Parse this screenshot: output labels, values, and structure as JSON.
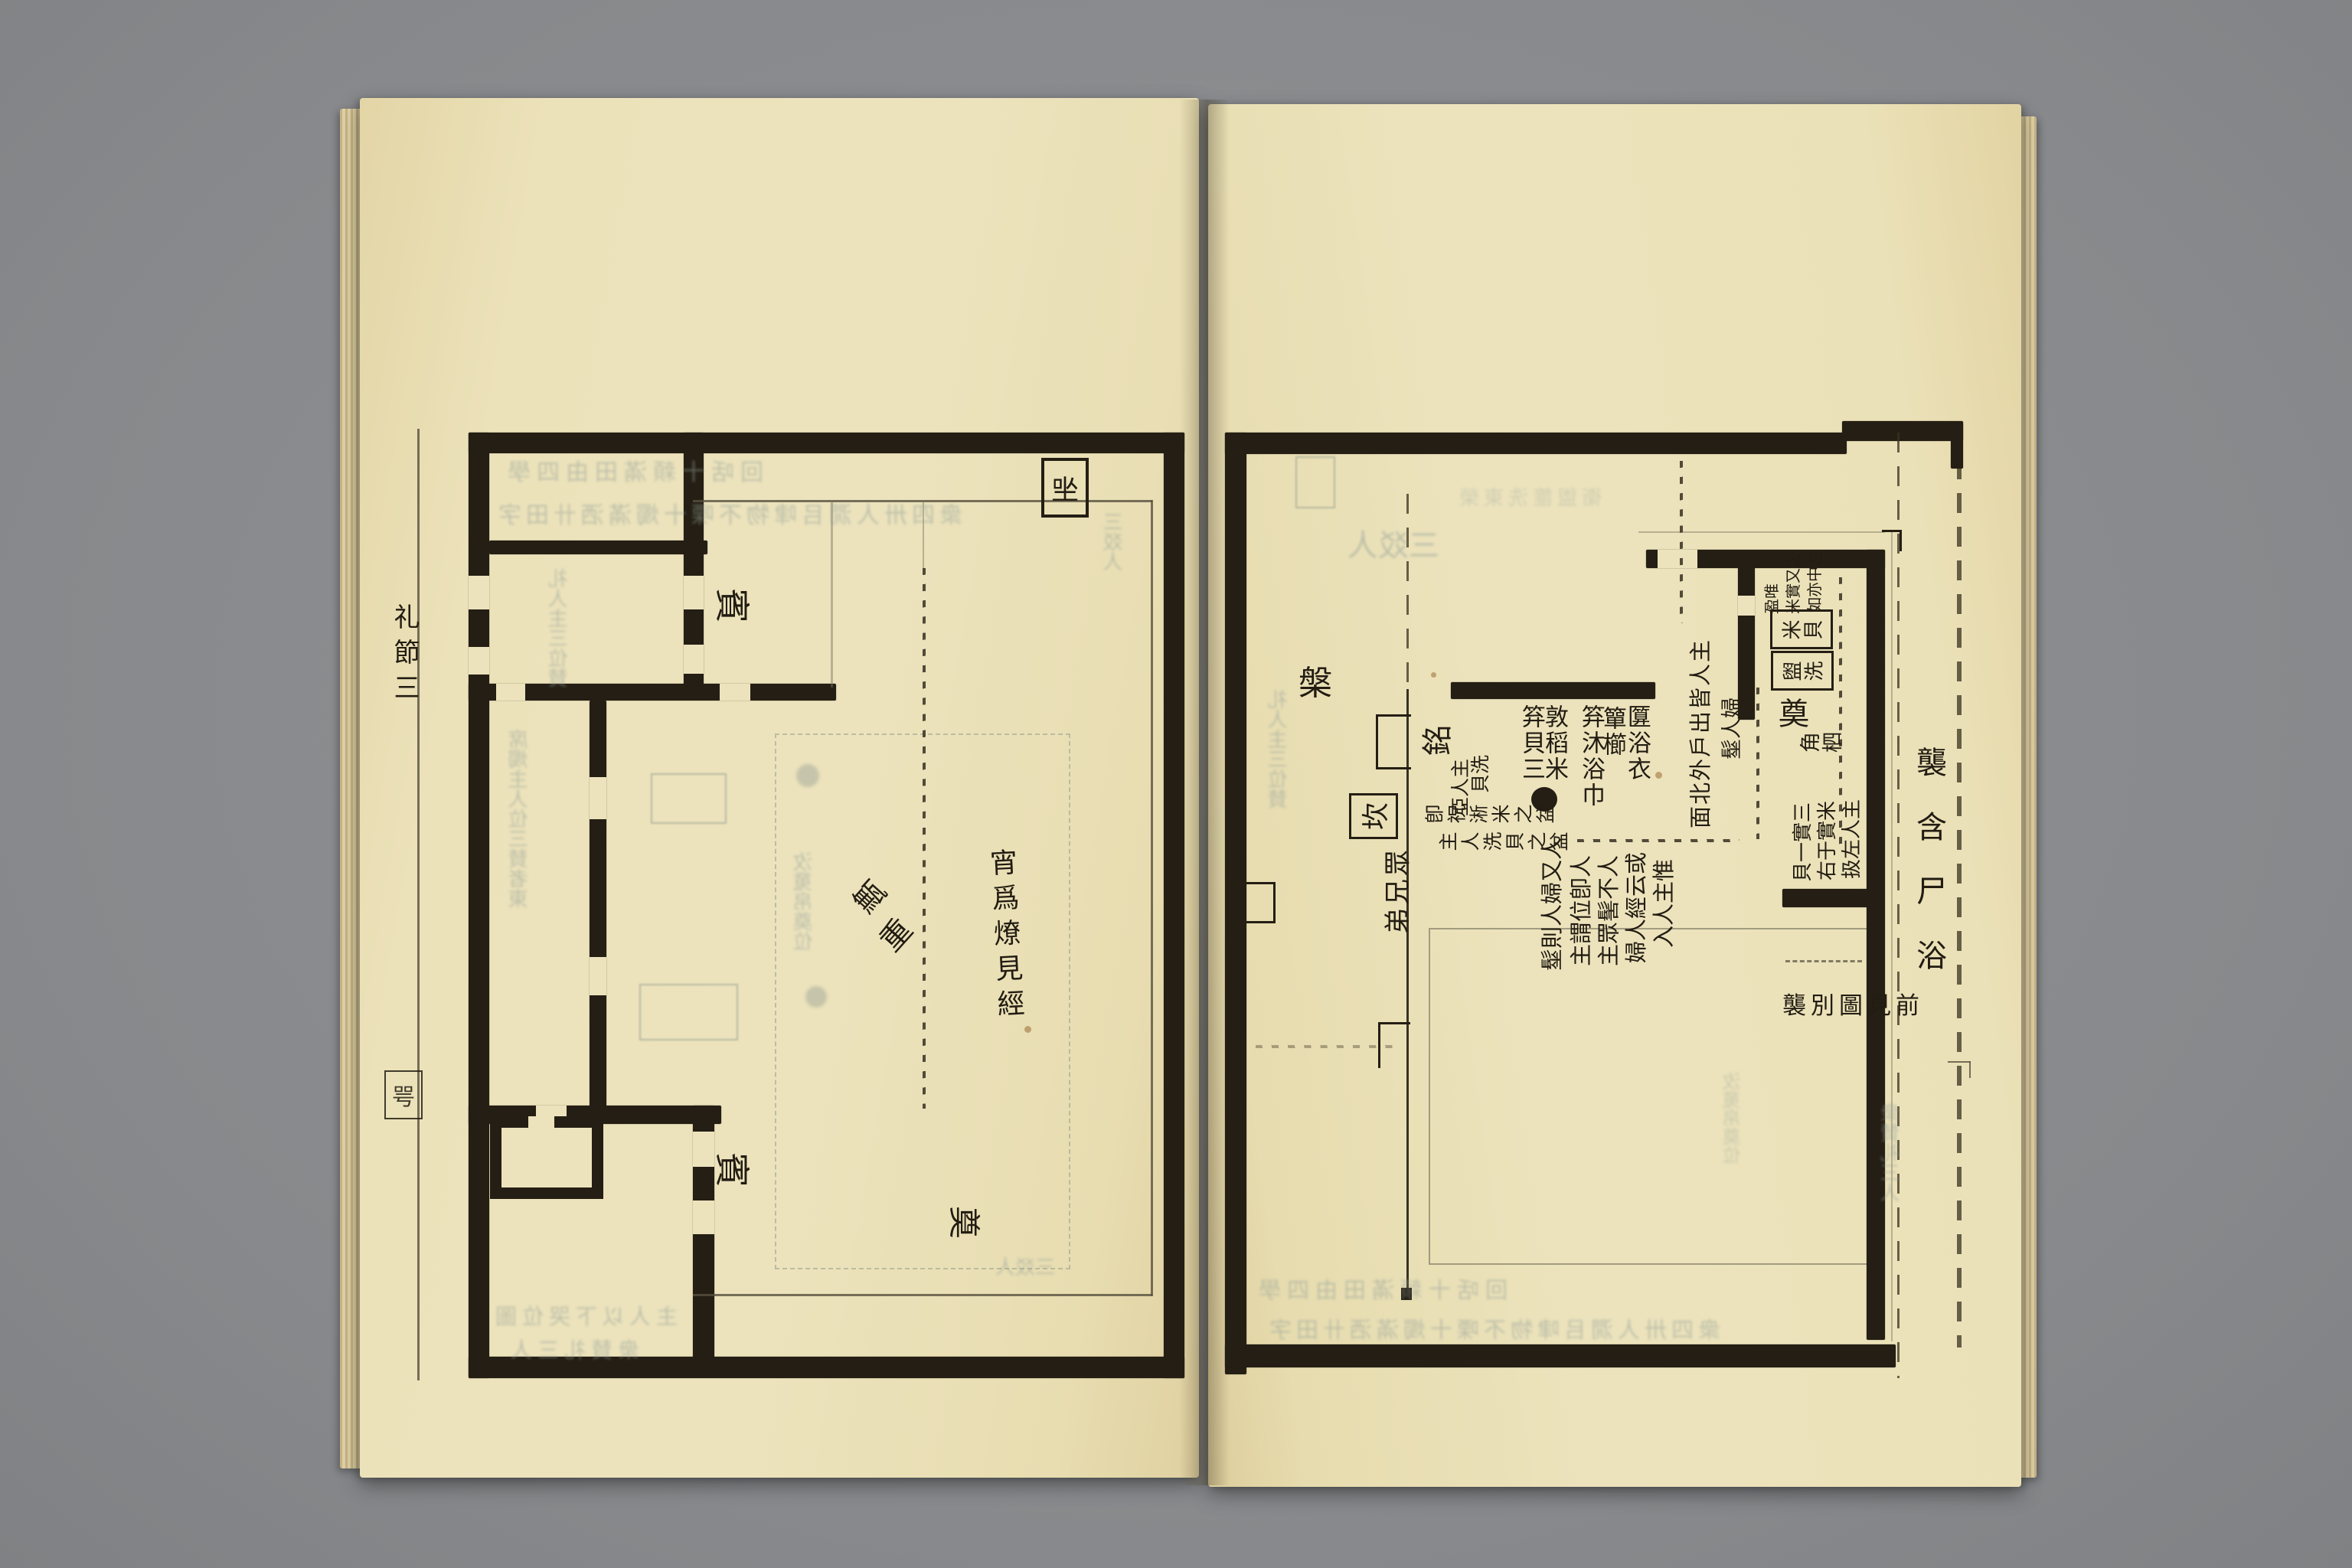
{
  "book": {
    "background": "#8c8e91",
    "paper": "#ece3bd",
    "ink": "#241e14",
    "bleed": "#93a099"
  },
  "left_page": {
    "margin_title": "礼節三",
    "margin_mark": "咢",
    "boxed_seat": "㘴",
    "guest_upper": "賓",
    "guest_lower": "賓",
    "post_char_1": "甒",
    "post_char_2": "重",
    "torch_note": "宵爲燎見經",
    "offering": "奠"
  },
  "right_page": {
    "margin_rites": "襲含尸浴",
    "basin": "槃",
    "inscription": "銘",
    "pit": "坎",
    "brothers": "眾兄弟",
    "offering": "奠",
    "horn_spoon": "角柶",
    "items": [
      "匴浴衣",
      "簞櫛",
      "笲沐浴巾",
      "敦稻米",
      "笲貝三"
    ],
    "door_note": "主人皆出戶外北面",
    "women_note": "婦人髽",
    "wash_note_1": "洗貝",
    "wash_note_2": "主人亞",
    "basin_note_1": "卽祝淅米之盆",
    "basin_note_2": "主人洗貝之盆",
    "note_cols": [
      "惟主人入",
      "或云經人婦",
      "人不髺眾主",
      "人卽位謂主",
      "人又婦人則髽"
    ],
    "rice_note_cols": [
      "左中亦如",
      "之又實米",
      "唯盈"
    ],
    "insert_cols": [
      "主人左扱",
      "米實于右",
      "三實一貝"
    ],
    "boxed_rice": "米貝",
    "boxed_wash": "盥洗",
    "see_previous": "襲別圖見前"
  },
  "decor": {
    "bleed_row_1": "滿歌十咶坮十�…人㵎以",
    "bleed_row_2": "一㸚人㵎�used十田咶",
    "bleed_row_3": "礼人主三位賛",
    "bleed_row_4": "席燭主人位三賛者東",
    "bleed_row_5": "主人以下哭位圖",
    "bleed_row_6": "衆賛礼三人",
    "bleed_row_7": "㳊䰟帛奠位",
    "bleed_row_8": "衛盥篚洗東榮",
    "bleed_row_9": "三㸚人",
    "bleed_row_10": "回咶十䫙滿田甶四學",
    "bleed_row_11": "衆四卅人㵎㠯㖀物不㗚十燭滿洒卄田字"
  }
}
